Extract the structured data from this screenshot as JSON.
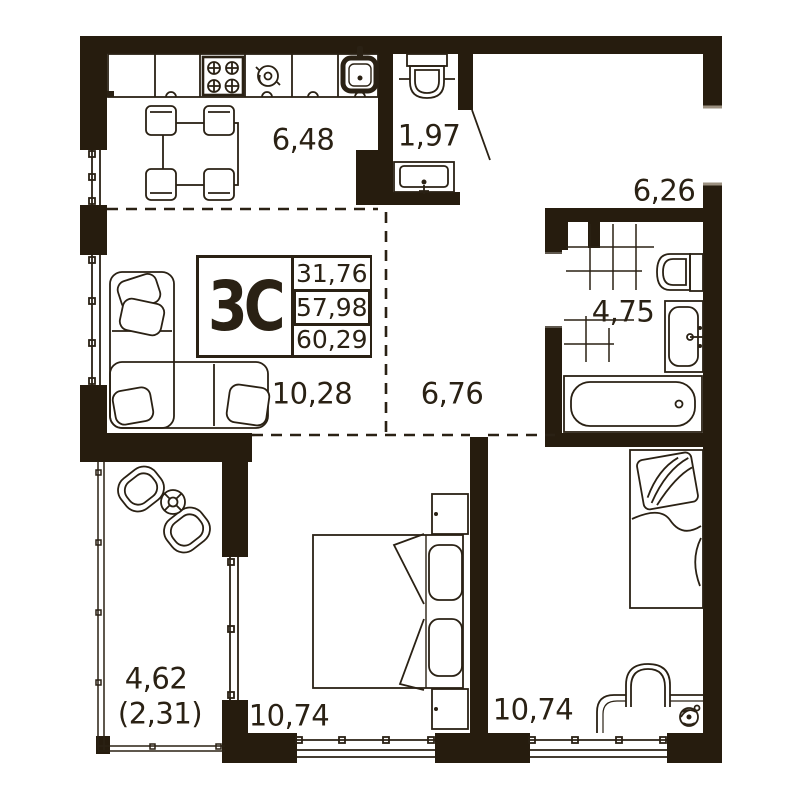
{
  "stamp": {
    "type": "3С",
    "values": [
      "31,76",
      "57,98",
      "60,29"
    ]
  },
  "rooms": {
    "kitchen": {
      "area": "6,48"
    },
    "wc": {
      "area": "1,97"
    },
    "entry": {
      "area": "6,26"
    },
    "bathroom": {
      "area": "4,75"
    },
    "hallway": {
      "area": "6,76"
    },
    "living": {
      "area": "10,28"
    },
    "bedroom_left": {
      "area": "10,74"
    },
    "bedroom_right": {
      "area": "10,74"
    },
    "balcony": {
      "area": "4,62",
      "area_coeff": "(2,31)"
    }
  },
  "colors": {
    "wall": "#261c0e",
    "line": "#2a2114",
    "background": "#ffffff"
  }
}
